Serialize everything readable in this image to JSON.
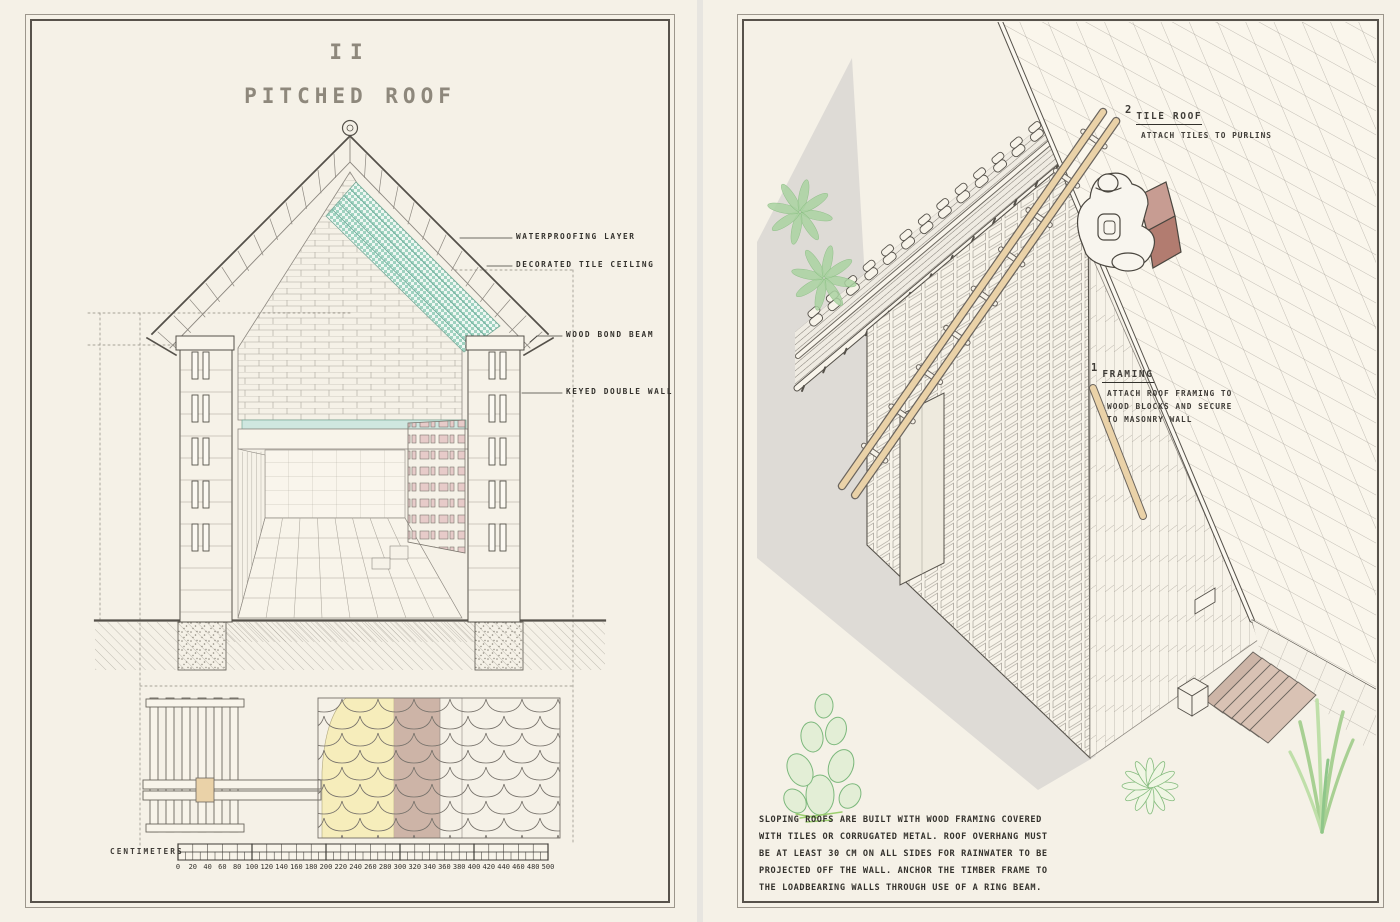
{
  "document": {
    "sheet_numeral": "II",
    "sheet_title": "PITCHED ROOF"
  },
  "left_page": {
    "callouts": [
      {
        "label": "WATERPROOFING LAYER"
      },
      {
        "label": "DECORATED TILE CEILING"
      },
      {
        "label": "WOOD BOND BEAM"
      },
      {
        "label": "KEYED DOUBLE WALL"
      }
    ],
    "scale_bar": {
      "unit_label": "CENTIMETERS",
      "tick_values": [
        0,
        20,
        40,
        60,
        80,
        100,
        120,
        140,
        160,
        180,
        200,
        220,
        240,
        260,
        280,
        300,
        320,
        340,
        360,
        380,
        400,
        420,
        440,
        460,
        480,
        500
      ]
    }
  },
  "right_page": {
    "steps": [
      {
        "number": "2",
        "title": "TILE ROOF",
        "note_lines": [
          "ATTACH TILES TO PURLINS"
        ]
      },
      {
        "number": "1",
        "title": "FRAMING",
        "note_lines": [
          "ATTACH ROOF FRAMING TO",
          "WOOD BLOCKS AND SECURE",
          "TO MASONRY WALL"
        ]
      }
    ],
    "caption_lines": [
      "SLOPING ROOFS ARE BUILT WITH WOOD FRAMING COVERED",
      "WITH TILES OR CORRUGATED METAL. ROOF OVERHANG MUST",
      "BE AT LEAST 30 CM ON ALL SIDES FOR RAINWATER TO BE",
      "PROJECTED OFF THE WALL. ANCHOR THE TIMBER FRAME TO",
      "THE LOADBEARING WALLS THROUGH USE OF A RING BEAM."
    ]
  },
  "colors": {
    "paper": "#f5f1e7",
    "gutter": "#e7e5e0",
    "frame_dark": "#57524b",
    "frame_light": "#9c968c",
    "ink": "#3f3c37",
    "line_gray": "#8d8880",
    "teal_checker": "#9fd2c0",
    "teal_floor": "#cfe7e0",
    "pink_tile": "#e7cbc9",
    "yellow_layer": "#f6edbb",
    "mauve_tile": "#c9ada0",
    "wood_tan": "#ead2a8",
    "terracotta": "#c0857a",
    "shadow_gray": "#dedbd6",
    "plant_stroke": "#7cb87c",
    "plant_fill": "#e3eed6"
  }
}
